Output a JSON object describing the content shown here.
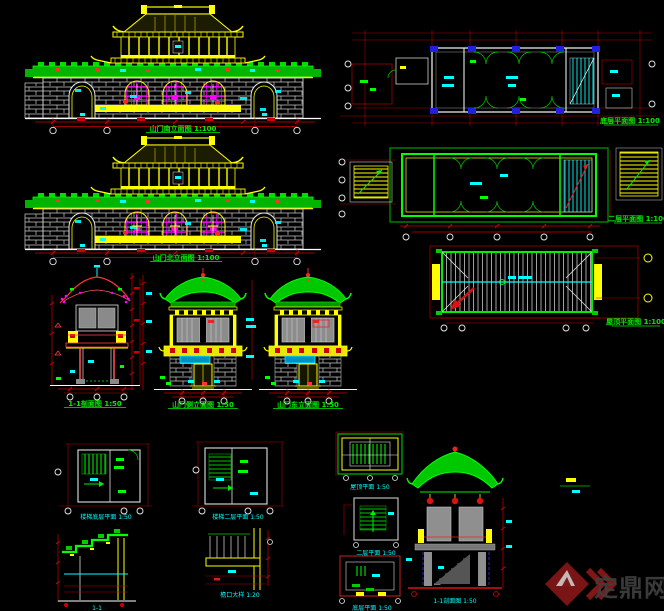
{
  "canvas": {
    "width": 664,
    "height": 611,
    "background": "#000000"
  },
  "palette": {
    "line_yellow": "#ffff00",
    "line_green": "#00ff00",
    "line_cyan": "#00ffff",
    "line_red": "#cc0000",
    "line_magenta": "#ff00ff",
    "line_white": "#e8e8e8",
    "line_blue": "#2020dd",
    "poche_gray": "#8c8c8c",
    "watermark_red": "#801616",
    "watermark_gray": "#3f3f3f"
  },
  "views": {
    "front_elevation": {
      "label": "山门南立面图 1:100"
    },
    "rear_elevation": {
      "label": "山门北立面图 1:100"
    },
    "section_1_1": {
      "label": "1-1剖面图 1:50"
    },
    "side_elevation_a": {
      "label": "山门侧立面图 1:50"
    },
    "side_elevation_b": {
      "label": "山门东立面图 1:50"
    },
    "first_floor_plan": {
      "label": "底层平面图 1:100"
    },
    "second_floor_plan": {
      "label": "二层平面图 1:100"
    },
    "roof_plan": {
      "label": "屋顶平面图 1:100"
    },
    "stair_plan_lower": {
      "label": "楼梯底层平面 1:50"
    },
    "stair_plan_upper": {
      "label": "楼梯二层平面 1:50"
    },
    "parapet_section": {
      "label": "1-1"
    },
    "eave_detail": {
      "label": "檐口大样 1:20"
    },
    "kiosk_roof_plan": {
      "label": "屋顶平面 1:50"
    },
    "kiosk_upper_plan": {
      "label": "二层平面 1:50"
    },
    "kiosk_ground_plan": {
      "label": "底层平面 1:50"
    },
    "kiosk_section": {
      "label": "1-1剖面图 1:50"
    }
  },
  "watermark": {
    "text": "定鼎网",
    "logo": "dingding-diamond-logo"
  }
}
